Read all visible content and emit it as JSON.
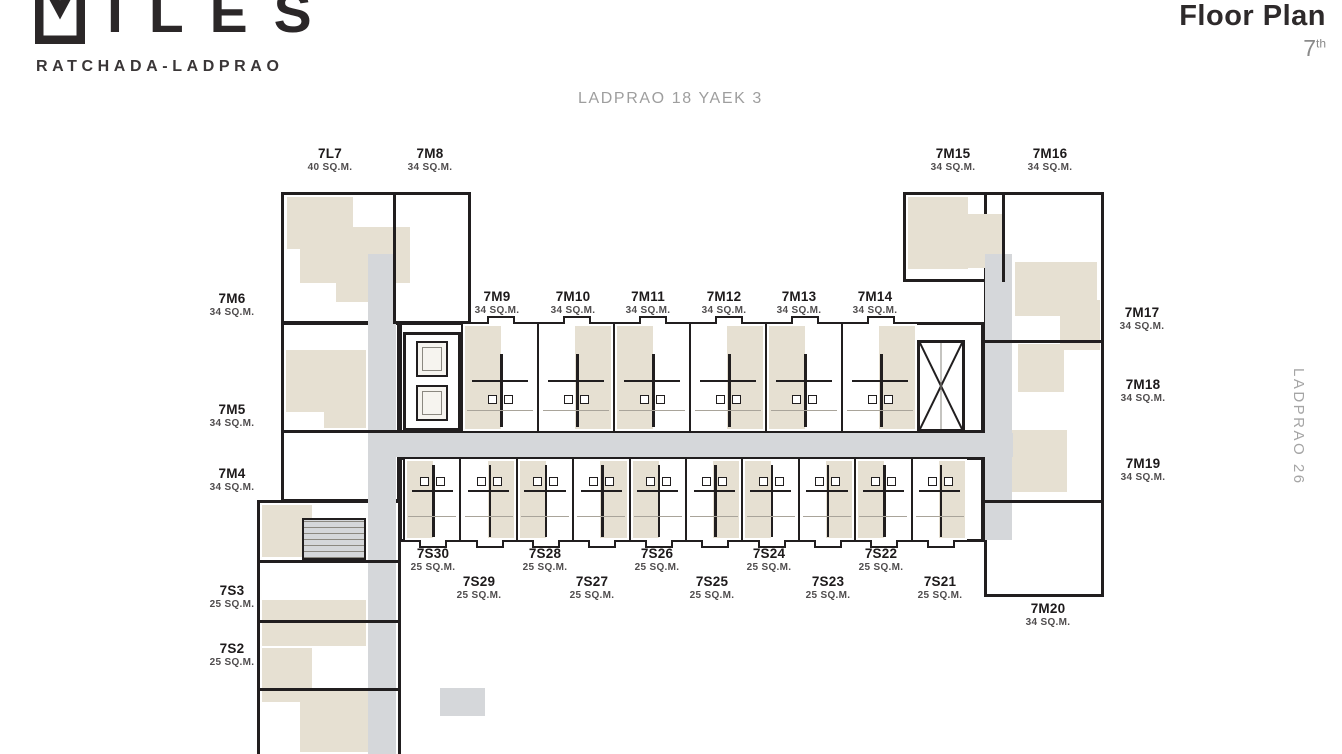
{
  "brand": {
    "logo_text": "ILES",
    "logo_mark": "miles-m-mark",
    "subtitle": "RATCHADA-LADPRAO"
  },
  "header": {
    "title": "Floor Plan",
    "floor_number": "7",
    "floor_suffix": "th"
  },
  "streets": {
    "top": "LADPRAO 18  YAEK 3",
    "right": "LADPRAO 26"
  },
  "colors": {
    "wall": "#211e1f",
    "room_beige": "#e6e0d2",
    "corridor_gray": "#d5d7da",
    "text_gray": "#9e9e9e"
  },
  "units": [
    {
      "name": "7L7",
      "size": "40 SQ.M.",
      "x": 330,
      "y": 146
    },
    {
      "name": "7M8",
      "size": "34 SQ.M.",
      "x": 430,
      "y": 146
    },
    {
      "name": "7M15",
      "size": "34 SQ.M.",
      "x": 953,
      "y": 146
    },
    {
      "name": "7M16",
      "size": "34 SQ.M.",
      "x": 1050,
      "y": 146
    },
    {
      "name": "7M6",
      "size": "34 SQ.M.",
      "x": 232,
      "y": 291
    },
    {
      "name": "7M9",
      "size": "34 SQ.M.",
      "x": 497,
      "y": 289
    },
    {
      "name": "7M10",
      "size": "34 SQ.M.",
      "x": 573,
      "y": 289
    },
    {
      "name": "7M11",
      "size": "34 SQ.M.",
      "x": 648,
      "y": 289
    },
    {
      "name": "7M12",
      "size": "34 SQ.M.",
      "x": 724,
      "y": 289
    },
    {
      "name": "7M13",
      "size": "34 SQ.M.",
      "x": 799,
      "y": 289
    },
    {
      "name": "7M14",
      "size": "34 SQ.M.",
      "x": 875,
      "y": 289
    },
    {
      "name": "7M17",
      "size": "34 SQ.M.",
      "x": 1142,
      "y": 305
    },
    {
      "name": "7M5",
      "size": "34 SQ.M.",
      "x": 232,
      "y": 402
    },
    {
      "name": "7M18",
      "size": "34 SQ.M.",
      "x": 1143,
      "y": 377
    },
    {
      "name": "7M4",
      "size": "34 SQ.M.",
      "x": 232,
      "y": 466
    },
    {
      "name": "7M19",
      "size": "34 SQ.M.",
      "x": 1143,
      "y": 456
    },
    {
      "name": "7S30",
      "size": "25 SQ.M.",
      "x": 433,
      "y": 546
    },
    {
      "name": "7S28",
      "size": "25 SQ.M.",
      "x": 545,
      "y": 546
    },
    {
      "name": "7S26",
      "size": "25 SQ.M.",
      "x": 657,
      "y": 546
    },
    {
      "name": "7S24",
      "size": "25 SQ.M.",
      "x": 769,
      "y": 546
    },
    {
      "name": "7S22",
      "size": "25 SQ.M.",
      "x": 881,
      "y": 546
    },
    {
      "name": "7S29",
      "size": "25 SQ.M.",
      "x": 479,
      "y": 574
    },
    {
      "name": "7S27",
      "size": "25 SQ.M.",
      "x": 592,
      "y": 574
    },
    {
      "name": "7S25",
      "size": "25 SQ.M.",
      "x": 712,
      "y": 574
    },
    {
      "name": "7S23",
      "size": "25 SQ.M.",
      "x": 828,
      "y": 574
    },
    {
      "name": "7S21",
      "size": "25 SQ.M.",
      "x": 940,
      "y": 574
    },
    {
      "name": "7S3",
      "size": "25 SQ.M.",
      "x": 232,
      "y": 583
    },
    {
      "name": "7S2",
      "size": "25 SQ.M.",
      "x": 232,
      "y": 641
    },
    {
      "name": "7M20",
      "size": "34 SQ.M.",
      "x": 1048,
      "y": 601
    }
  ]
}
